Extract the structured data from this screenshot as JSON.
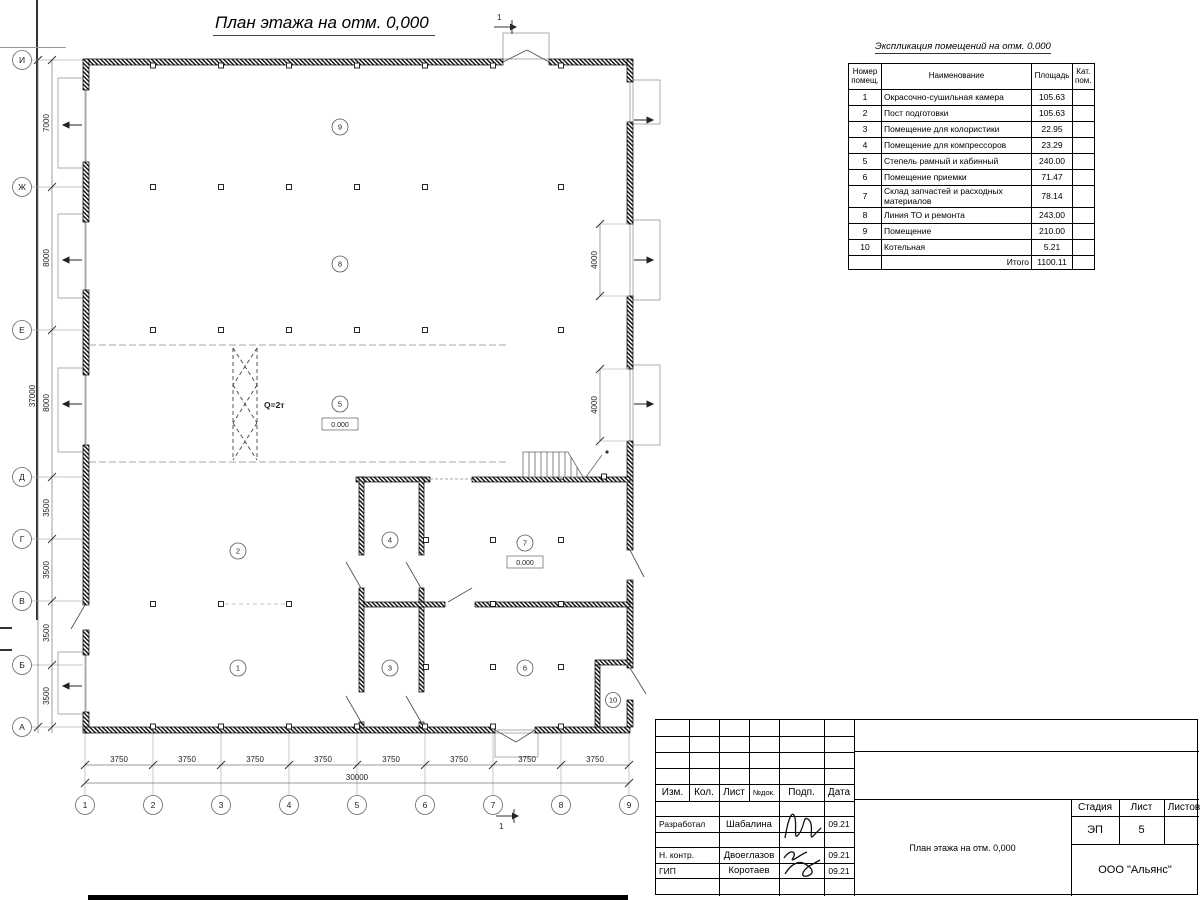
{
  "plan": {
    "title": "План этажа на отм. 0,000",
    "section_mark": "1",
    "crane_label": "Q=2т",
    "levels": [
      "0.000",
      "0.000"
    ],
    "rooms": [
      "1",
      "2",
      "3",
      "4",
      "5",
      "6",
      "7",
      "8",
      "9",
      "10"
    ],
    "row_labels": [
      "И",
      "Ж",
      "Е",
      "Д",
      "Г",
      "В",
      "Б",
      "А"
    ],
    "row_dims": [
      "7000",
      "8000",
      "8000",
      "3500",
      "3500",
      "3500",
      "3500"
    ],
    "total_height": "37000",
    "col_labels": [
      "1",
      "2",
      "3",
      "4",
      "5",
      "6",
      "7",
      "8",
      "9"
    ],
    "col_dims": [
      "3750",
      "3750",
      "3750",
      "3750",
      "3750",
      "3750",
      "3750",
      "3750"
    ],
    "total_width": "30000",
    "gate_dims": [
      "4000",
      "4000"
    ]
  },
  "schedule": {
    "title": "Экспликация помещений на отм. 0.000",
    "col_num": "Номер помещ.",
    "col_name": "Наименование",
    "col_area": "Площадь",
    "col_cat": "Кат. пом.",
    "rows": [
      {
        "num": "1",
        "name": "Окрасочно-сушильная камера",
        "area": "105.63"
      },
      {
        "num": "2",
        "name": "Пост подготовки",
        "area": "105.63"
      },
      {
        "num": "3",
        "name": "Помещение для колористики",
        "area": "22.95"
      },
      {
        "num": "4",
        "name": "Помещение для компрессоров",
        "area": "23.29"
      },
      {
        "num": "5",
        "name": "Степель рамный и кабинный",
        "area": "240.00"
      },
      {
        "num": "6",
        "name": "Помещение приемки",
        "area": "71.47"
      },
      {
        "num": "7",
        "name": "Склад запчастей и расходных материалов",
        "area": "78.14"
      },
      {
        "num": "8",
        "name": "Линия ТО и ремонта",
        "area": "243.00"
      },
      {
        "num": "9",
        "name": "Помещение",
        "area": "210.00"
      },
      {
        "num": "10",
        "name": "Котельная",
        "area": "5.21"
      }
    ],
    "total_label": "Итого",
    "total_area": "1100.11"
  },
  "titleblock": {
    "rev_cols": [
      "Изм.",
      "Кол.",
      "Лист",
      "№док.",
      "Подп.",
      "Дата"
    ],
    "sig_rows": [
      {
        "role": "Разработал",
        "name": "Шабалина",
        "date": "09.21"
      },
      {
        "role": "Н. контр.",
        "name": "Двоеглазов",
        "date": "09.21"
      },
      {
        "role": "ГИП",
        "name": "Коротаев",
        "date": "09.21"
      }
    ],
    "stage_label": "Стадия",
    "sheet_label": "Лист",
    "sheets_label": "Листов",
    "stage": "ЭП",
    "sheet_number": "5",
    "doc_title": "План этажа на отм. 0,000",
    "company": "ООО \"Альянс\""
  }
}
